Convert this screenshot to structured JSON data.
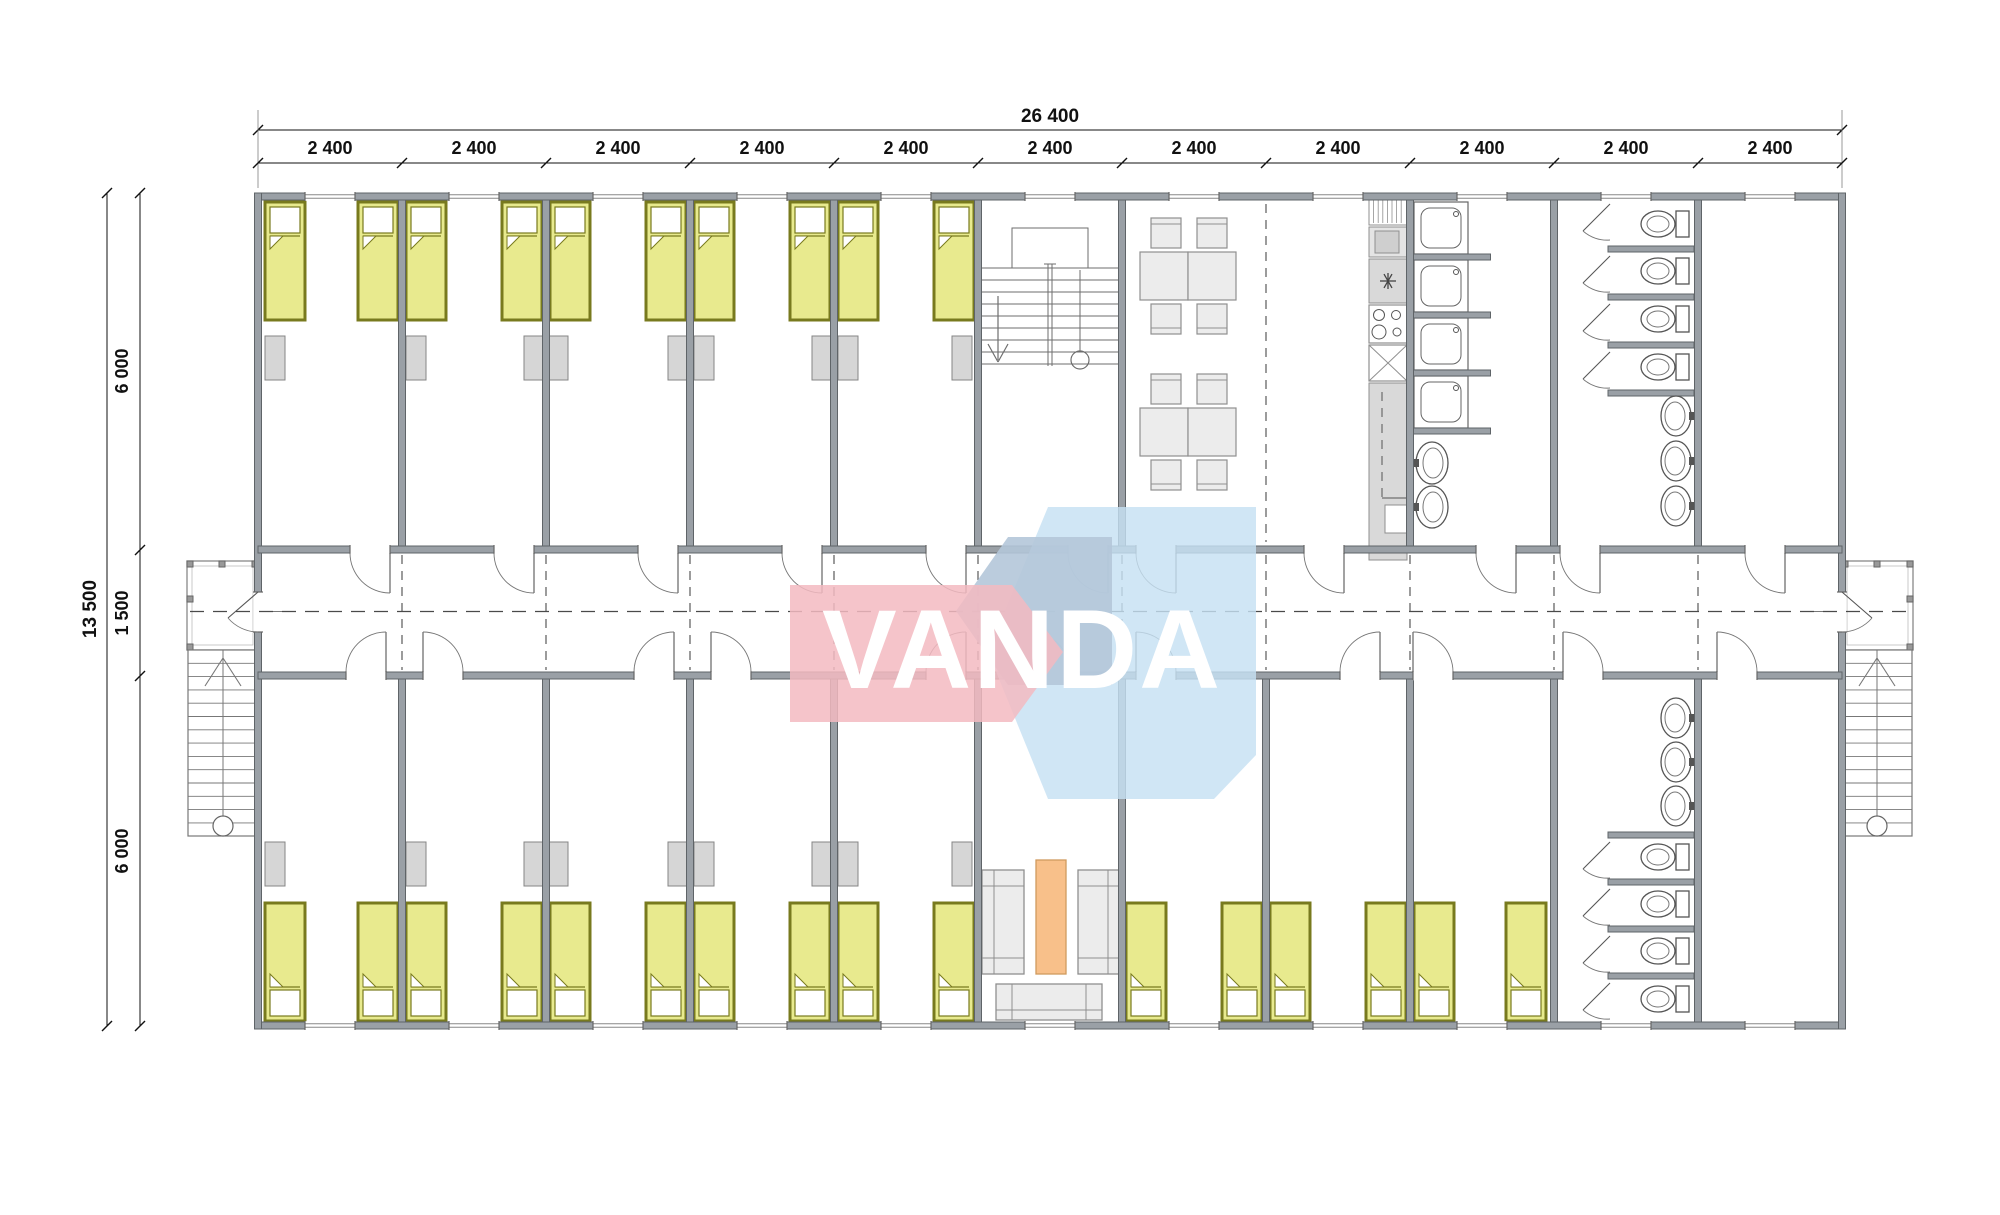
{
  "document": {
    "kind": "modular-building-floor-plan"
  },
  "dimensions": {
    "top": {
      "overall": "26 400",
      "segments": [
        "2 400",
        "2 400",
        "2 400",
        "2 400",
        "2 400",
        "2 400",
        "2 400",
        "2 400",
        "2 400",
        "2 400",
        "2 400"
      ]
    },
    "left": {
      "overall": "13 500",
      "segments": [
        "6 000",
        "1 500",
        "6 000"
      ]
    }
  },
  "logo": {
    "text": "VANDA",
    "colors": {
      "pink": "#f3bac1",
      "blue": "#c6e0f3",
      "panel": "#b4c6d9",
      "text": "#ffffff"
    }
  },
  "colors": {
    "wall": "#9aa0a6",
    "wall_stroke": "#5f6468",
    "thin_line": "#6e6e6e",
    "dash": "#4a4a4a",
    "dim": "#111111",
    "bed_fill": "#e8ea8e",
    "bed_stroke": "#787a1e",
    "cabinet_fill": "#d6d6d6",
    "cabinet_stroke": "#858585",
    "furniture_fill": "#ececec",
    "furniture_stroke": "#8f8f8f",
    "counter_fill": "#d9d9d9",
    "table_orange": "#f8c08a",
    "table_orange_stroke": "#d09a5e"
  },
  "fixtures": {
    "beds": 26,
    "wardrobes": 18,
    "dining_tables": 4,
    "dining_chairs": 8,
    "showers": 4,
    "wash_basins": 8,
    "kitchen_sink": 1,
    "kitchen_range": 1,
    "toilets": 8,
    "sofas": 3,
    "coffee_table": 1,
    "interior_staircase": 1,
    "exterior_porches": 2,
    "exterior_staircases": 2
  }
}
